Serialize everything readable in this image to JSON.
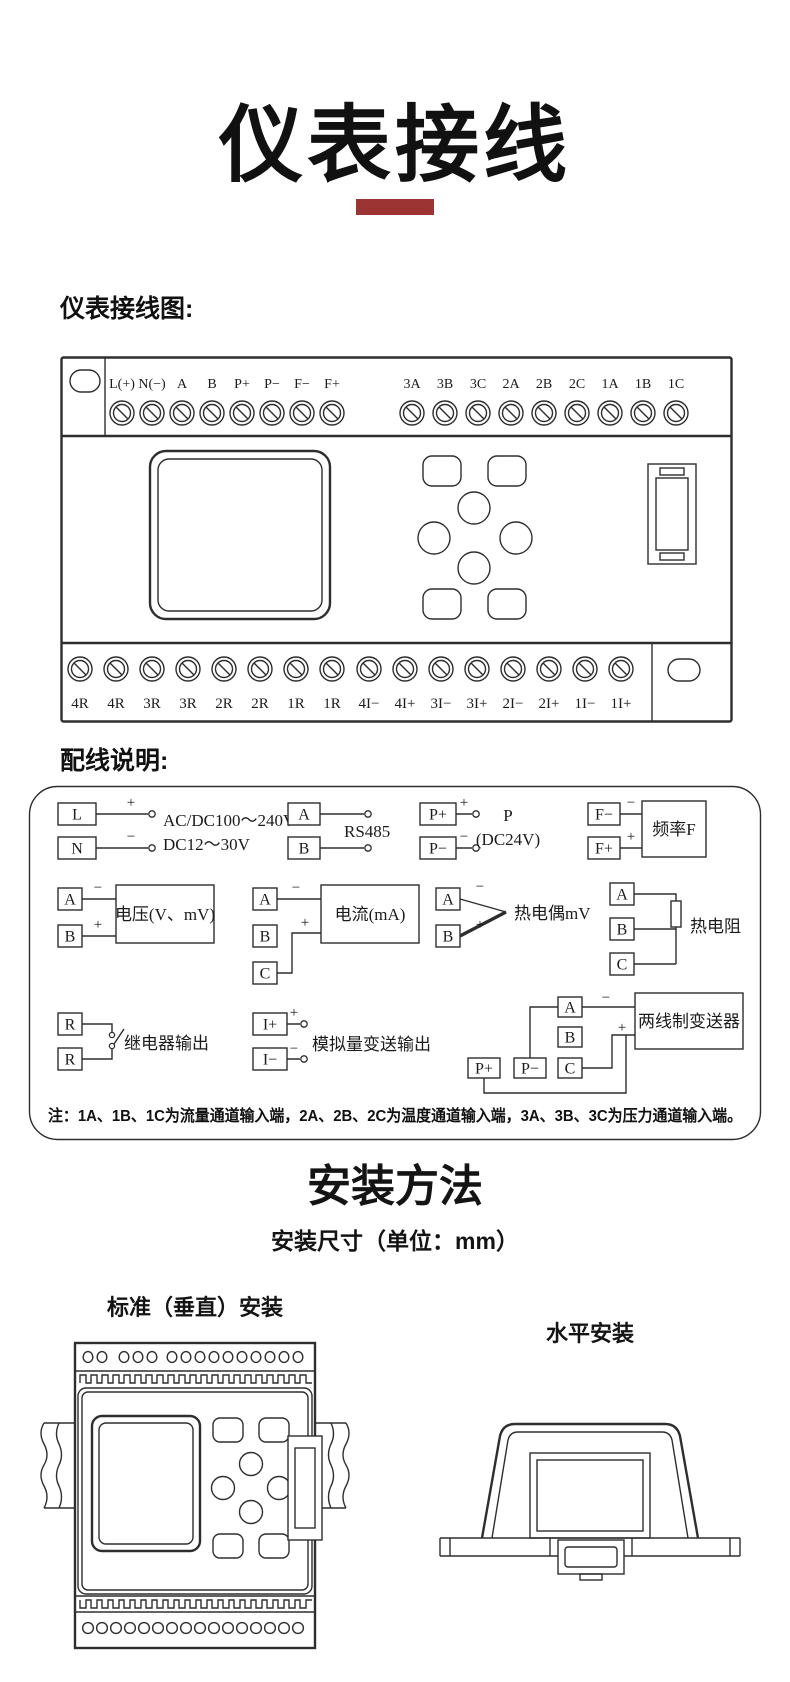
{
  "page_title": "仪表接线",
  "colors": {
    "accent_bar": "#9c3434"
  },
  "sections": {
    "wiring_diagram_heading": "仪表接线图:",
    "wiring_notes_heading": "配线说明:",
    "install_heading": "安装方法",
    "install_subheading": "安装尺寸（单位：mm）",
    "vertical_install_label": "标准（垂直）安装",
    "horizontal_install_label": "水平安装"
  },
  "main_diagram": {
    "top_terminals": [
      "L(+)",
      "N(−)",
      "A",
      "B",
      "P+",
      "P−",
      "F−",
      "F+",
      "3A",
      "3B",
      "3C",
      "2A",
      "2B",
      "2C",
      "1A",
      "1B",
      "1C"
    ],
    "bottom_terminals": [
      "4R",
      "4R",
      "3R",
      "3R",
      "2R",
      "2R",
      "1R",
      "1R",
      "4I−",
      "4I+",
      "3I−",
      "3I+",
      "2I−",
      "2I+",
      "1I−",
      "1I+"
    ]
  },
  "wiring_notes": {
    "power": {
      "t1": "L",
      "t2": "N",
      "p1": "+",
      "p2": "−",
      "line1": "AC/DC100～240V",
      "line2": "DC12～30V"
    },
    "rs485": {
      "t1": "A",
      "t2": "B",
      "label": "RS485"
    },
    "aux_power": {
      "t1": "P+",
      "t2": "P−",
      "p1": "+",
      "p2": "−",
      "line1": "P",
      "line2": "(DC24V)"
    },
    "frequency": {
      "t1": "F−",
      "t2": "F+",
      "p1": "−",
      "p2": "+",
      "box": "频率F"
    },
    "voltage": {
      "t1": "A",
      "t2": "B",
      "p1": "−",
      "p2": "+",
      "box": "电压(V、mV)"
    },
    "current": {
      "t1": "A",
      "t2": "B",
      "t3": "C",
      "p1": "−",
      "p2": "+",
      "box": "电流(mA)"
    },
    "thermocouple": {
      "t1": "A",
      "t2": "B",
      "p1": "−",
      "p2": "+",
      "label": "热电偶mV"
    },
    "rtd": {
      "t1": "A",
      "t2": "B",
      "t3": "C",
      "label": "热电阻"
    },
    "relay": {
      "t1": "R",
      "t2": "R",
      "label": "继电器输出"
    },
    "analog_output": {
      "t1": "I+",
      "t2": "I−",
      "p1": "+",
      "p2": "−",
      "label": "模拟量变送输出"
    },
    "two_wire_transmitter": {
      "t1": "A",
      "t2": "B",
      "t3": "C",
      "t4": "P+",
      "t5": "P−",
      "p1": "−",
      "p2": "+",
      "box": "两线制变送器"
    },
    "note": "注：1A、1B、1C为流量通道输入端，2A、2B、2C为温度通道输入端，3A、3B、3C为压力通道输入端。"
  }
}
